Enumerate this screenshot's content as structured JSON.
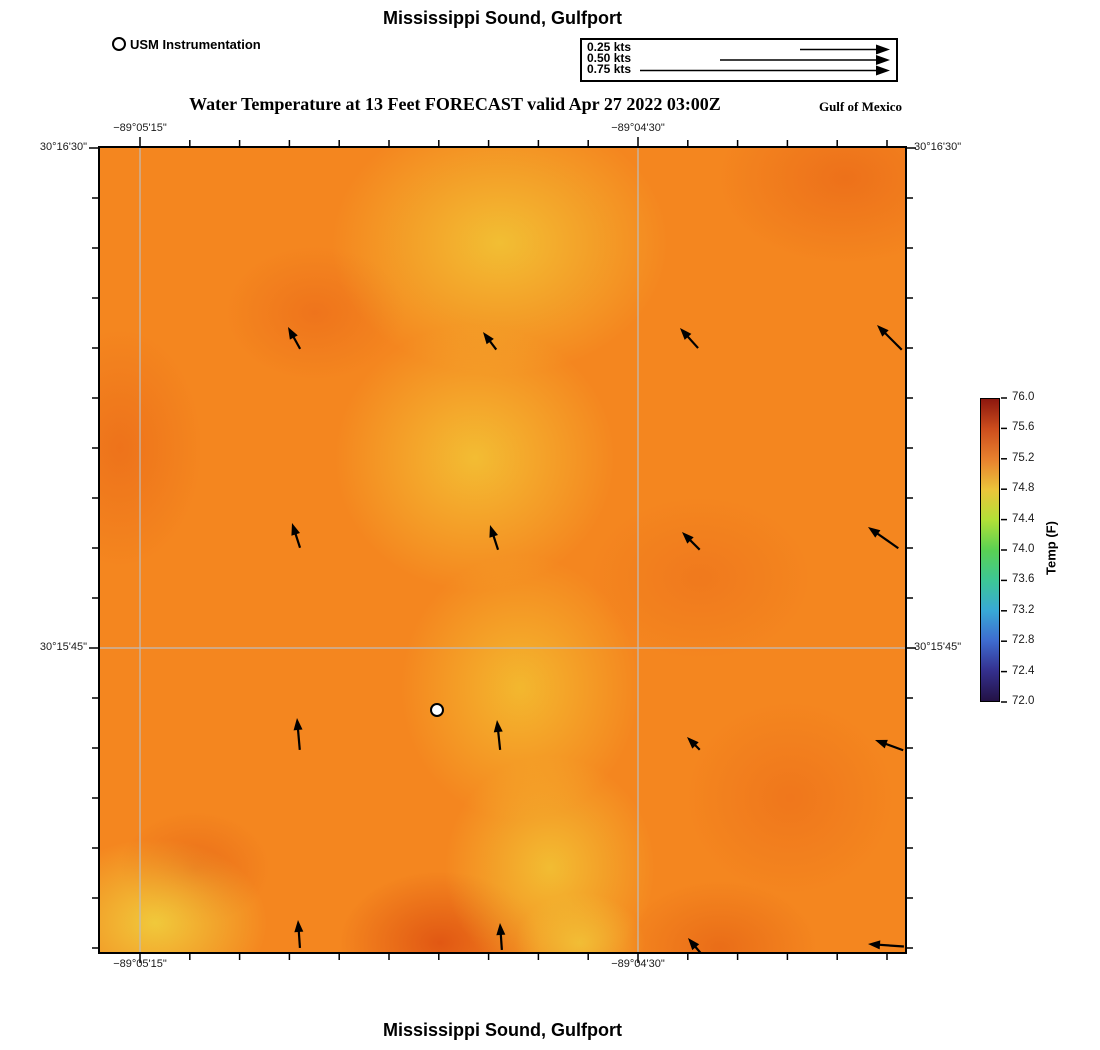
{
  "page": {
    "title_top": "Mississippi Sound, Gulfport",
    "title_bottom": "Mississippi Sound, Gulfport"
  },
  "instrument_legend": {
    "label": "USM Instrumentation"
  },
  "forecast_header": {
    "text": "Water Temperature at 13 Feet FORECAST valid Apr 27 2022 03:00Z",
    "region": "Gulf of Mexico"
  },
  "velocity_legend": {
    "rows": [
      {
        "label": "0.25 kts",
        "arrow_length_px": 90
      },
      {
        "label": "0.50 kts",
        "arrow_length_px": 170
      },
      {
        "label": "0.75 kts",
        "arrow_length_px": 250
      }
    ]
  },
  "map_axes": {
    "lon_labels": [
      {
        "text": "−89°05'15\"",
        "x_px": 40
      },
      {
        "text": "−89°04'30\"",
        "x_px": 538
      }
    ],
    "lat_labels": [
      {
        "text": "30°16'30\"",
        "y_px": 0
      },
      {
        "text": "30°15'45\"",
        "y_px": 500
      }
    ]
  },
  "colorbar": {
    "label": "Temp (F)",
    "ticks": [
      "76.0",
      "75.6",
      "75.2",
      "74.8",
      "74.4",
      "74.0",
      "73.6",
      "73.2",
      "72.8",
      "72.4",
      "72.0"
    ],
    "gradient_bottom_to_top": [
      "#231245",
      "#34308e",
      "#3e6cd0",
      "#38a9d6",
      "#3dc795",
      "#5ad153",
      "#b2e037",
      "#ecc43a",
      "#e8812e",
      "#cd4e1d",
      "#8c170e"
    ]
  },
  "chart_data": {
    "type": "heatmap",
    "title": "Mississippi Sound, Gulfport",
    "variable": "Water Temperature at 13 Feet",
    "forecast_valid": "Apr 27 2022 03:00Z",
    "region": "Gulf of Mexico",
    "x_tick_labels": [
      "−89°05'15\"",
      "−89°04'30\""
    ],
    "y_tick_labels": [
      "30°16'30\"",
      "30°15'45\""
    ],
    "colorbar": {
      "label": "Temp (F)",
      "min": 72.0,
      "max": 76.0,
      "tick_interval": 0.4
    },
    "field_summary": "Smooth water-temperature field ~74.2-75.5 F: yellow (~74.4 F) band running from the bottom-left corner up through the center to top-center; darker orange (~75.4 F) patches on the left edge, top-left-center, top-right corner, right-center and bottom-center; base orange ~75.0 F",
    "station": {
      "name": "USM Instrumentation",
      "x_px": 337,
      "y_px": 562
    },
    "velocity_legend_kts": [
      0.25,
      0.5,
      0.75
    ],
    "current_vectors": [
      {
        "x": 188,
        "y": 179,
        "angle_deg": 119,
        "length_px": 25
      },
      {
        "x": 383,
        "y": 184,
        "angle_deg": 127,
        "length_px": 22
      },
      {
        "x": 580,
        "y": 180,
        "angle_deg": 132,
        "length_px": 27
      },
      {
        "x": 777,
        "y": 177,
        "angle_deg": 135,
        "length_px": 35
      },
      {
        "x": 192,
        "y": 375,
        "angle_deg": 108,
        "length_px": 26
      },
      {
        "x": 390,
        "y": 377,
        "angle_deg": 108,
        "length_px": 26
      },
      {
        "x": 582,
        "y": 384,
        "angle_deg": 135,
        "length_px": 25
      },
      {
        "x": 768,
        "y": 379,
        "angle_deg": 145,
        "length_px": 37
      },
      {
        "x": 197,
        "y": 570,
        "angle_deg": 95,
        "length_px": 32
      },
      {
        "x": 397,
        "y": 572,
        "angle_deg": 96,
        "length_px": 30
      },
      {
        "x": 587,
        "y": 589,
        "angle_deg": 135,
        "length_px": 18
      },
      {
        "x": 775,
        "y": 592,
        "angle_deg": 160,
        "length_px": 30
      },
      {
        "x": 198,
        "y": 772,
        "angle_deg": 94,
        "length_px": 28
      },
      {
        "x": 400,
        "y": 775,
        "angle_deg": 94,
        "length_px": 27
      },
      {
        "x": 588,
        "y": 790,
        "angle_deg": 130,
        "length_px": 20
      },
      {
        "x": 768,
        "y": 796,
        "angle_deg": 176,
        "length_px": 36
      }
    ]
  }
}
